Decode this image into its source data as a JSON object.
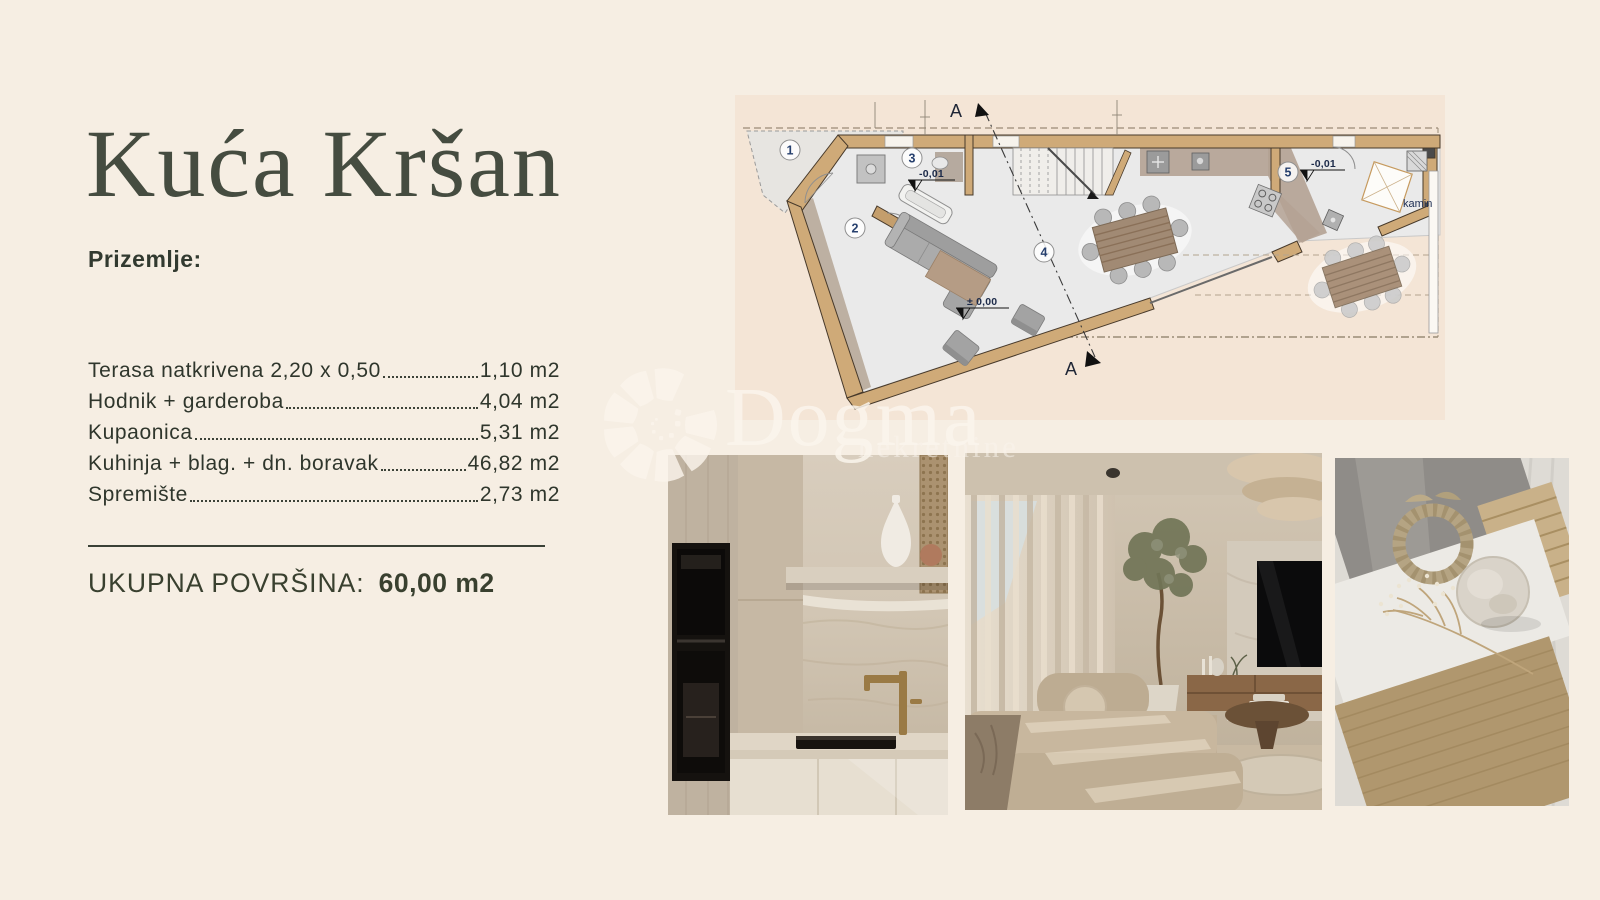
{
  "page": {
    "background": "#f6eee3"
  },
  "header": {
    "title": "Kuća Kršan"
  },
  "details": {
    "section_label": "Prizemlje:",
    "rooms": [
      {
        "label": "Terasa natkrivena 2,20 x 0,50",
        "value": "1,10 m2"
      },
      {
        "label": "Hodnik + garderoba",
        "value": "4,04 m2"
      },
      {
        "label": "Kupaonica",
        "value": "5,31 m2"
      },
      {
        "label": "Kuhinja + blag. + dn. boravak",
        "value": "46,82 m2"
      },
      {
        "label": "Spremište",
        "value": "2,73 m2"
      }
    ],
    "total_label": "UKUPNA POVRŠINA:",
    "total_value": "60,00 m2"
  },
  "floor_plan": {
    "room_numbers": [
      "1",
      "2",
      "3",
      "4",
      "5"
    ],
    "elevation_bath": "-0,01",
    "elevation_living": "± 0,00",
    "elevation_storage": "-0,01",
    "fireplace_label": "kamin",
    "section_top": "A",
    "section_bottom": "A",
    "colors": {
      "wall": "#cfaa78",
      "floor": "#eaeaea",
      "furniture": "#ababab",
      "table_wood": "#a18a74"
    }
  },
  "watermark": {
    "brand": "Dogma",
    "subtitle": "nekretnine"
  }
}
